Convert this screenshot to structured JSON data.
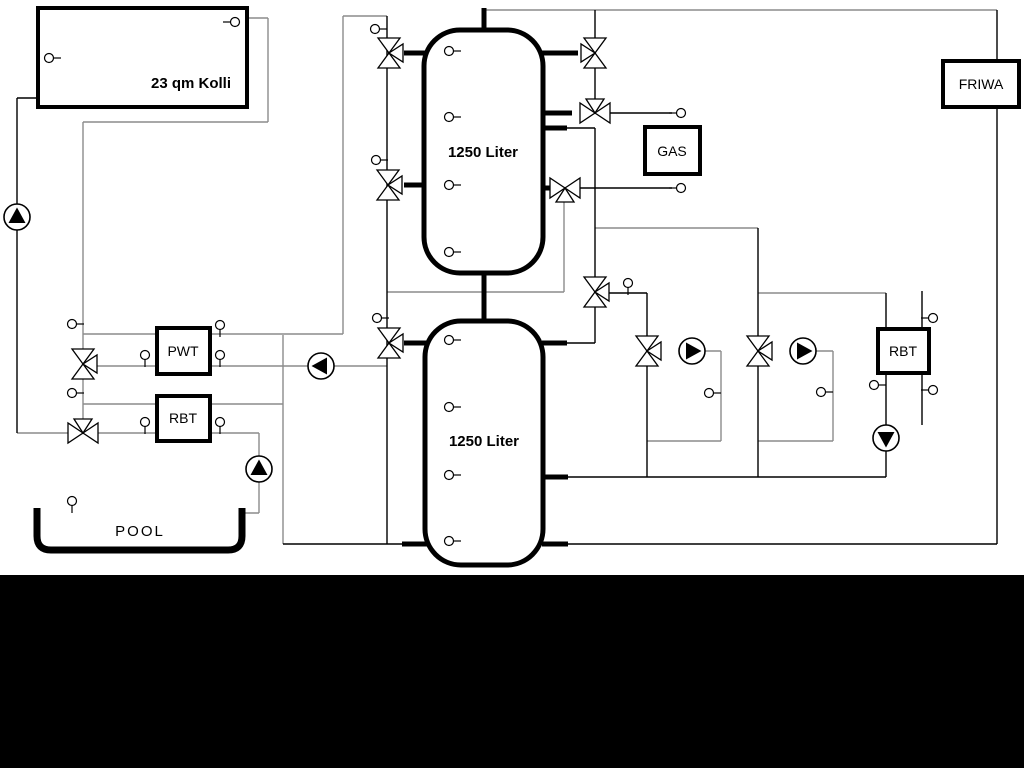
{
  "schematic": {
    "collector": {
      "label": "23 qm Kolli"
    },
    "buffer_tank_top": {
      "label": "1250 Liter"
    },
    "buffer_tank_bottom": {
      "label": "1250 Liter"
    },
    "heat_exchanger_pwt": {
      "label": "PWT"
    },
    "heat_exchanger_rbt_pool": {
      "label": "RBT"
    },
    "gas_boiler": {
      "label": "GAS"
    },
    "fresh_water_station": {
      "label": "FRIWA"
    },
    "heat_exchanger_rbt_dhw": {
      "label": "RBT"
    },
    "pool": {
      "label": "POOL"
    },
    "icons": {
      "pump": "circle-with-triangle",
      "three_way_valve": "double-triangle-bowtie",
      "sensor": "small-circle-with-stem"
    },
    "colors": {
      "pipe_gray": "#8c8c8c",
      "pipe_black": "#000000",
      "component_fill": "#ffffff",
      "background": "#ffffff",
      "bottom_bar": "#000000"
    }
  }
}
